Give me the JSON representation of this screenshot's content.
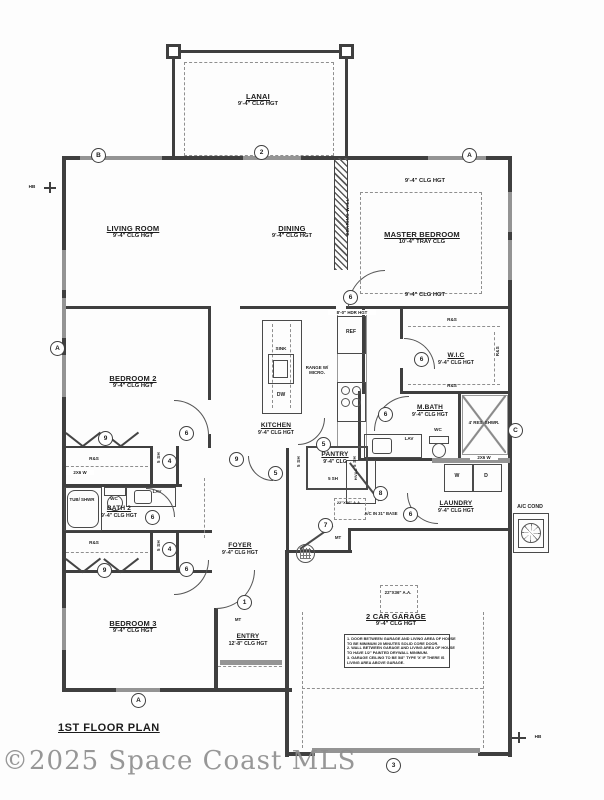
{
  "title": "1ST FLOOR PLAN",
  "watermark": "©2025 Space Coast MLS",
  "rooms": {
    "lanai": {
      "name": "LANAI",
      "clg": "9'-4\" CLG HGT"
    },
    "living": {
      "name": "LIVING ROOM",
      "clg": "9'-4\" CLG HGT"
    },
    "dining": {
      "name": "DINING",
      "clg": "9'-4\" CLG HGT"
    },
    "master": {
      "name": "MASTER BEDROOM",
      "clg": "10'-4\" TRAY CLG",
      "clg_top": "9'-4\" CLG HGT",
      "clg_bottom": "9'-4\" CLG HGT"
    },
    "wic": {
      "name": "W.I.C",
      "clg": "9'-4\" CLG HGT"
    },
    "mbath": {
      "name": "M.BATH",
      "clg": "9'-4\" CLG HGT"
    },
    "kitchen": {
      "name": "KITCHEN",
      "clg": "9'-4\" CLG HGT"
    },
    "pantry": {
      "name": "PANTRY",
      "clg": "9'-4\" CLG"
    },
    "bedroom2": {
      "name": "BEDROOM 2",
      "clg": "9'-4\" CLG HGT"
    },
    "bath2": {
      "name": "BATH 2",
      "clg": "9'-4\" CLG HGT"
    },
    "bedroom3": {
      "name": "BEDROOM 3",
      "clg": "9'-4\" CLG HGT"
    },
    "foyer": {
      "name": "FOYER",
      "clg": "9'-4\" CLG HGT"
    },
    "entry": {
      "name": "ENTRY",
      "clg": "12'-8\" CLG HGT"
    },
    "laundry": {
      "name": "LAUNDRY",
      "clg": "9'-4\" CLG HGT"
    },
    "garage": {
      "name": "2 CAR GARAGE",
      "clg": "9'-4\" CLG HGT"
    },
    "ac_cond": {
      "name": "A/C COND"
    }
  },
  "labels": {
    "bearing_wall": "BEARING WALL",
    "hdr_hgt": "8'-0\" HDR HGT",
    "ref": "REF",
    "sink": "SINK",
    "dw": "DW",
    "range": "RANGE W/ MICRO.",
    "rod_shelf": "R&S",
    "shelves5": "5 SH",
    "wc": "WC",
    "lav": "LAV",
    "tub_shwr": "TUB/ SHWR",
    "res_shwr": "4' RES. SHWR.",
    "washer": "W",
    "dryer": "D",
    "wall_2x6": "2X6 W",
    "hvac": "HVAC",
    "attic_access": "22\"X36\" A.A.",
    "ac_in_base": "A/C IN 31\" BASE",
    "mt": "MT",
    "hb": "HB"
  },
  "markers": {
    "a": "A",
    "b": "B",
    "c": "C",
    "n1": "1",
    "n2": "2",
    "n3": "3",
    "n4": "4",
    "n5": "5",
    "n6": "6",
    "n7": "7",
    "n8": "8",
    "n9": "9"
  },
  "garage_note": [
    "1. DOOR BETWEEN GARAGE AND LIVING AREA OF HOUSE",
    "    TO BE MINIMUM 20 MINUTES SOLID CORE DOOR.",
    "2. WALL BETWEEN GARAGE AND LIVING AREA OF HOUSE",
    "    TO HAVE 1/2\" PAINTED DRYWALL MINIMUM.",
    "3. GARAGE CEILING TO BE 5/8\" TYPE 'X' IF THERE IS",
    "    LIVING AREA ABOVE GARAGE."
  ],
  "colors": {
    "line": "#3f3f3f",
    "window": "#949494",
    "watermark": "#8d8d8d"
  }
}
